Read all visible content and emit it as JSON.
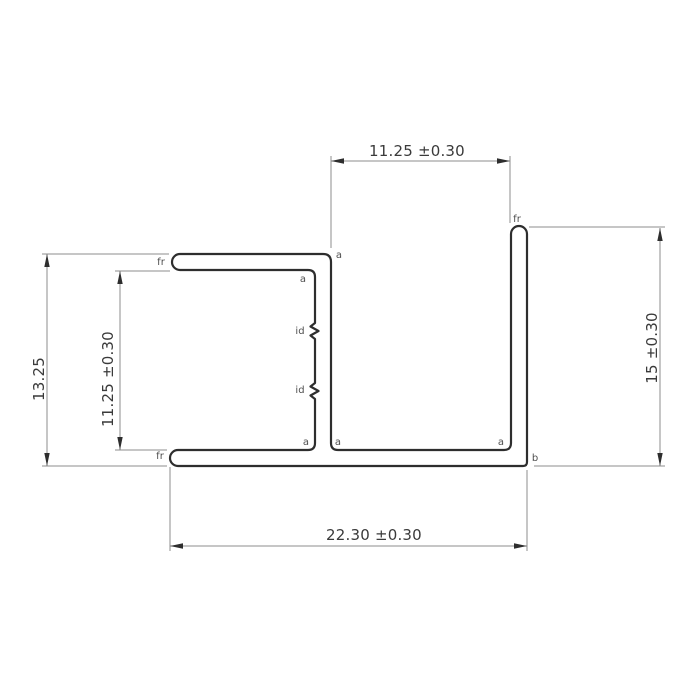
{
  "page": {
    "background_color": "#ffffff",
    "drawing_type": "profile-cross-section-dimension-drawing"
  },
  "style": {
    "profile_stroke_color": "#2e2e2e",
    "dimension_line_color": "#8c8c8c",
    "arrow_color": "#2e2e2e",
    "dimension_text_color": "#3a3a3a",
    "point_label_color": "#4f4f4f"
  },
  "dimensions": {
    "top_width": {
      "label": "11.25 ±0.30"
    },
    "right_height": {
      "label": "15 ±0.30"
    },
    "left_outer_height": {
      "label": "13.25"
    },
    "left_inner_height": {
      "label": "11.25 ±0.30"
    },
    "bottom_width": {
      "label": "22.30 ±0.30"
    }
  },
  "point_labels": {
    "fr_top_flange": "fr",
    "fr_right_leg": "fr",
    "fr_bottom_flange": "fr",
    "a_top_outer_corner": "a",
    "a_top_inner_corner": "a",
    "a_bottom_left_inner_corner": "a",
    "a_bottom_mid_inner_corner": "a",
    "a_bottom_right_inner_corner": "a",
    "b_bottom_right_corner": "b",
    "id_upper_mark": "id",
    "id_lower_mark": "id"
  }
}
